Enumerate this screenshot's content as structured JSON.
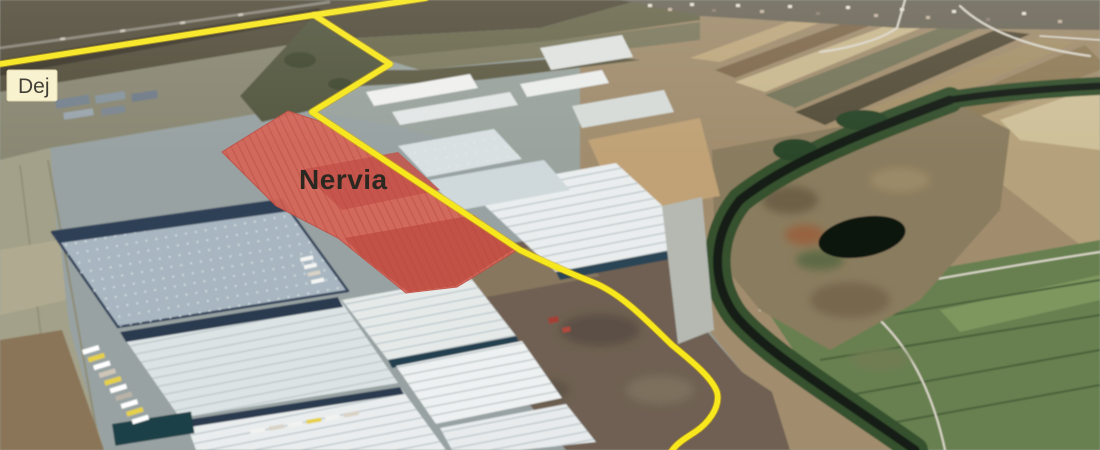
{
  "map": {
    "labels": {
      "origin": "Dej",
      "origin_box_color": "#f8f1cd",
      "origin_text_color": "#3a372e",
      "site": "Nervia",
      "site_text_color": "#2b2721"
    },
    "route": {
      "color": "#f7e71d",
      "casing_color": "#cfae12",
      "main_points": "0,64 314,15 426,-2",
      "branch_d": "M314,15 L390,64 L312,112 L520,250 C556,268 580,277 597,284 C625,297 648,322 672,345 C694,363 712,378 717,392 C721,408 707,424 695,432 C684,439 676,444 671,452"
    },
    "highlight": {
      "color": "#d66557",
      "border_color": "#c24f44",
      "points": "288,111 334,126 519,249 457,287 406,293 338,238 276,206 222,152"
    }
  }
}
